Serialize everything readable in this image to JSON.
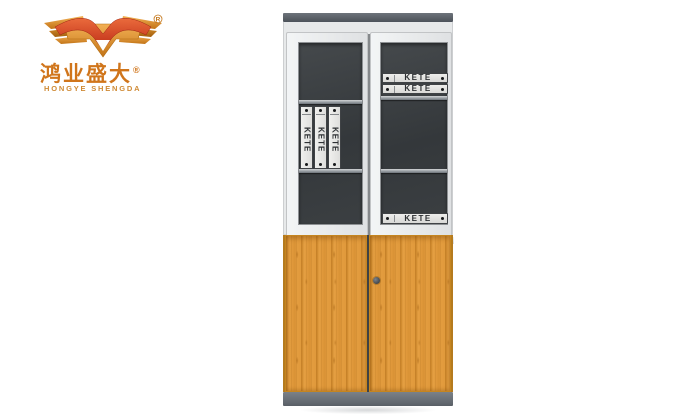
{
  "logo": {
    "brand_cn": "鸿业盛大",
    "brand_en": "HONGYE SHENGDA",
    "registered_mark": "®"
  },
  "cabinet": {
    "upper": {
      "left_door": {
        "vertical_binders": [
          {
            "label": "KETE"
          },
          {
            "label": "KETE"
          },
          {
            "label": "KETE"
          }
        ]
      },
      "right_door": {
        "top_binders": [
          {
            "label": "KETE"
          },
          {
            "label": "KETE"
          }
        ],
        "bottom_binders": [
          {
            "label": "KETE"
          }
        ]
      }
    },
    "colors": {
      "cap": "#5a6067",
      "plinth": "#6b7178",
      "frame_white": "#eef0f1",
      "glass_dark": "#3a3e41",
      "shelf": "#a8aeb2",
      "wood_base": "#e19a3c",
      "wood_grain_dark": "#c07820",
      "binder_face": "#e4e4e2",
      "binder_text": "#2e3134",
      "brand_orange": "#d0751b",
      "brand_red": "#cf3a1e"
    }
  }
}
